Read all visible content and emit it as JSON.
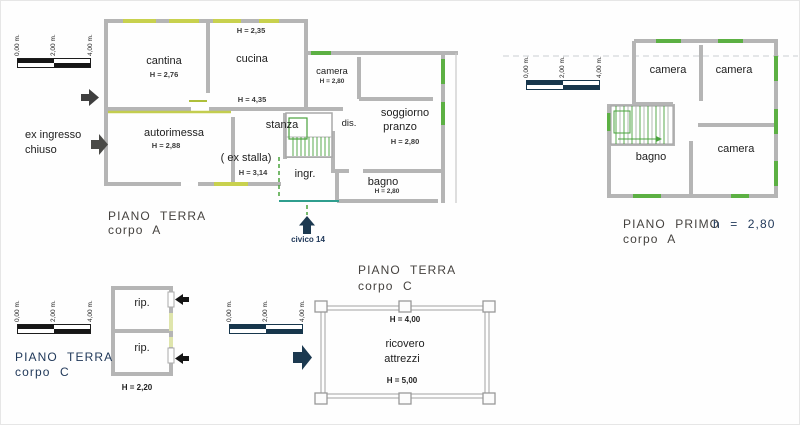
{
  "colors": {
    "wall_gray": "#b5b5b5",
    "window_yellow_green": "#c8d14e",
    "window_green": "#5cb043",
    "window_pale_green": "#dfe5ac",
    "stair_green": "#49a23c",
    "property_teal": "#2f9e8e",
    "navy_accent": "#1c3950",
    "scale_black": "#161616"
  },
  "scale_labels": [
    "0,00 m.",
    "2,00 m.",
    "4,00 m."
  ],
  "terra_a": {
    "title1": "PIANO TERRA",
    "title2": "corpo A",
    "cantina": "cantina",
    "cantina_h": "H = 2,76",
    "cucina": "cucina",
    "cucina_h": "H = 2,35",
    "camera": "camera",
    "camera_h": "H = 2,80",
    "h_mid": "H = 4,35",
    "dis": "dis.",
    "soggiorno1": "soggiorno",
    "soggiorno2": "pranzo",
    "soggiorno_h": "H = 2,80",
    "autorimessa": "autorimessa",
    "autorimessa_h": "H = 2,88",
    "stanza": "stanza",
    "stanza_note": "( ex stalla)",
    "stanza_h": "H = 3,14",
    "ingr": "ingr.",
    "bagno": "bagno",
    "bagno_h": "H = 2,80",
    "ex_ingresso1": "ex ingresso",
    "ex_ingresso2": "chiuso",
    "civico": "civico 14"
  },
  "primo_a": {
    "title1": "PIANO PRIMO",
    "title2": "corpo A",
    "height": "h = 2,80",
    "camera1": "camera",
    "camera2": "camera",
    "camera3": "camera",
    "bagno": "bagno"
  },
  "terra_c1": {
    "title1": "PIANO TERRA",
    "title2": "corpo C",
    "rip1": "rip.",
    "rip2": "rip.",
    "h": "H = 2,20"
  },
  "terra_c2": {
    "title1": "PIANO TERRA",
    "title2": "corpo C",
    "room1": "ricovero",
    "room2": "attrezzi",
    "h_top": "H = 4,00",
    "h_bottom": "H = 5,00"
  }
}
